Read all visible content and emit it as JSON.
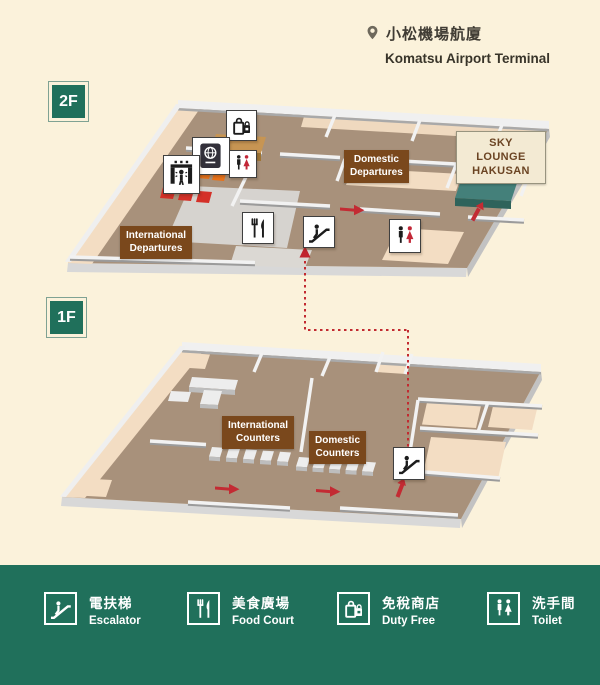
{
  "title": {
    "zh": "小松機場航廈",
    "en": "Komatsu Airport Terminal"
  },
  "floors": {
    "f2": {
      "label": "2F"
    },
    "f1": {
      "label": "1F"
    }
  },
  "map_labels": {
    "domestic_departures": {
      "line1": "Domestic",
      "line2": "Departures"
    },
    "international_departures": {
      "line1": "International",
      "line2": "Departures"
    },
    "sky_lounge": {
      "line1": "SKY LOUNGE",
      "line2": "HAKUSAN"
    },
    "international_counters": {
      "line1": "International",
      "line2": "Counters"
    },
    "domestic_counters": {
      "line1": "Domestic",
      "line2": "Counters"
    }
  },
  "map_icons": [
    "duty-free-icon",
    "passport-control-icon",
    "security-gate-icon",
    "toilet-icon",
    "food-court-icon",
    "escalator-icon",
    "location-pin-icon"
  ],
  "legend": {
    "items": [
      {
        "zh": "電扶梯",
        "en": "Escalator",
        "icon": "escalator-icon"
      },
      {
        "zh": "美食廣場",
        "en": "Food Court",
        "icon": "food-court-icon"
      },
      {
        "zh": "免稅商店",
        "en": "Duty Free",
        "icon": "duty-free-icon"
      },
      {
        "zh": "洗手間",
        "en": "Toilet",
        "icon": "toilet-icon"
      }
    ]
  },
  "colors": {
    "background": "#FBF2DB",
    "brand_green": "#20705B",
    "floor_brown": "#A8917B",
    "floor_peach": "#F3DDC3",
    "label_brown": "#7A481C",
    "arrow_red": "#C32B33",
    "lounge_teal": "#44807A",
    "counter_tan": "#C79553",
    "security_red": "#D43028",
    "security_orange": "#E8721A"
  }
}
